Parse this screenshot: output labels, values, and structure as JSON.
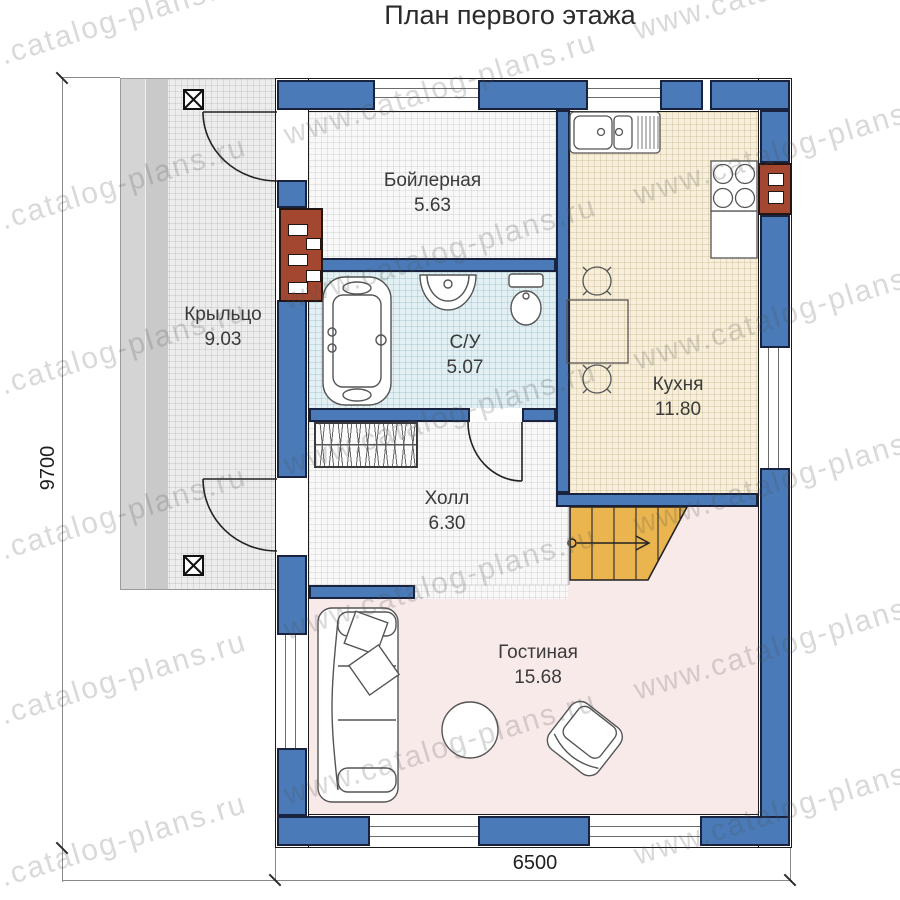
{
  "title": "План первого этажа",
  "watermark": "www.catalog-plans.ru",
  "rooms": {
    "boiler": {
      "name": "Бойлерная",
      "area": "5.63"
    },
    "porch": {
      "name": "Крыльцо",
      "area": "9.03"
    },
    "bathroom": {
      "name": "С/У",
      "area": "5.07"
    },
    "kitchen": {
      "name": "Кухня",
      "area": "11.80"
    },
    "hall": {
      "name": "Холл",
      "area": "6.30"
    },
    "living": {
      "name": "Гостиная",
      "area": "15.68"
    }
  },
  "dimensions": {
    "width": "6500",
    "height": "9700"
  },
  "colors": {
    "wall_blue": "#4a7ab8",
    "chimney_red": "#a34731",
    "stairs_yellow": "#eab54e",
    "kitchen_floor": "#f7efdb",
    "bathroom_floor": "#e2eff3",
    "living_floor": "#f9eaea",
    "porch_floor": "#ededed"
  }
}
